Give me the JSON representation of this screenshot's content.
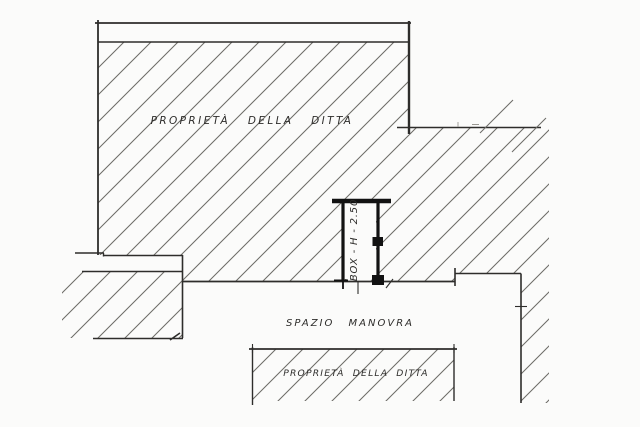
{
  "plan": {
    "labels": {
      "top_property": "PROPRIETÀ DELLA DITTA",
      "maneuver_space": "SPAZIO MANOVRA",
      "bottom_property": "PROPRIETÀ DELLA DITTA",
      "box": "BOX - H - 2.50"
    },
    "colors": {
      "background": "#fbfbfa",
      "line": "#2e2d2b",
      "hatch": "#6d6c68",
      "box_line": "#121212",
      "faint": "#9a9892"
    }
  }
}
